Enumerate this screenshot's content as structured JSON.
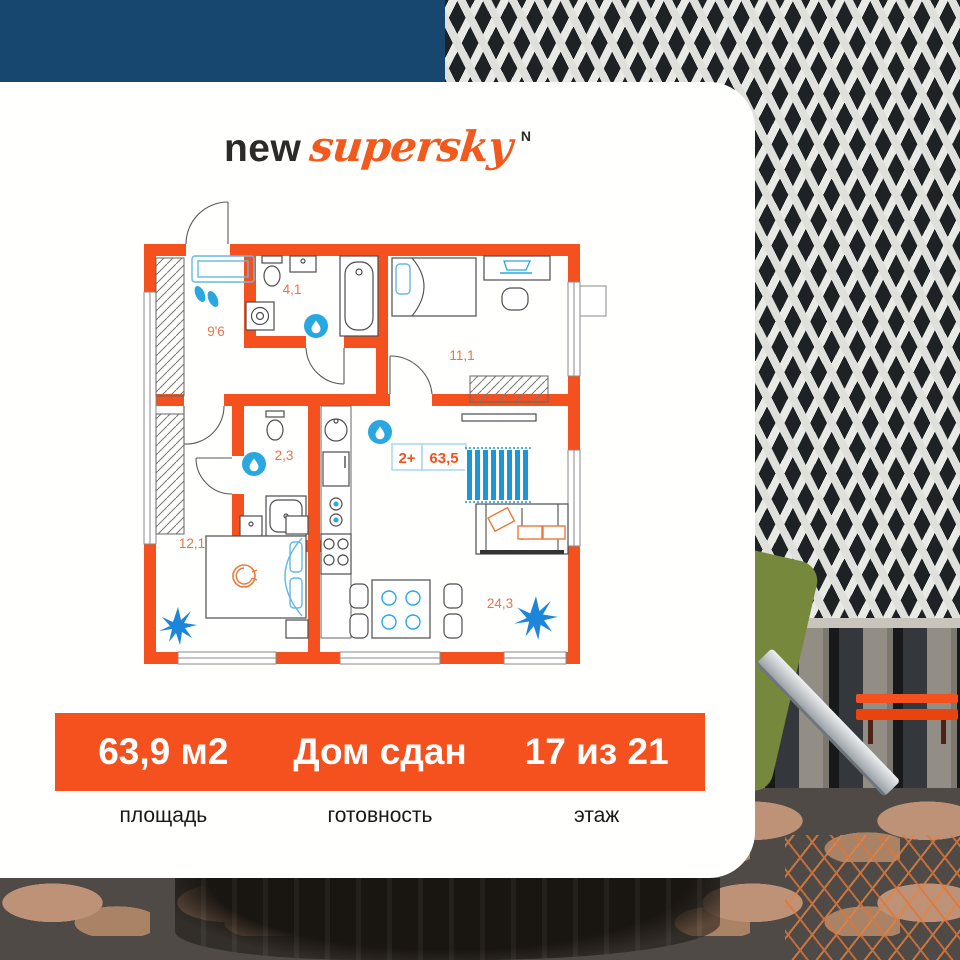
{
  "brand": {
    "logo_prefix": "new",
    "logo_script": "supersky",
    "logo_mark": "N"
  },
  "floorplan": {
    "badge": {
      "type": "2+",
      "area": "63,5"
    },
    "labels": {
      "hallway": "9'6",
      "bathroom": "4,1",
      "bedroom_top": "11,1",
      "wc": "2,3",
      "bedroom_bottom": "12,1",
      "living": "24,3"
    }
  },
  "stats": [
    {
      "value": "63,9 м2",
      "label": "площадь"
    },
    {
      "value": "Дом сдан",
      "label": "готовность"
    },
    {
      "value": "17 из 21",
      "label": "этаж"
    }
  ],
  "colors": {
    "accent_orange": "#f4511e",
    "plan_blue": "#29a7e0",
    "sky": "#17466f"
  }
}
